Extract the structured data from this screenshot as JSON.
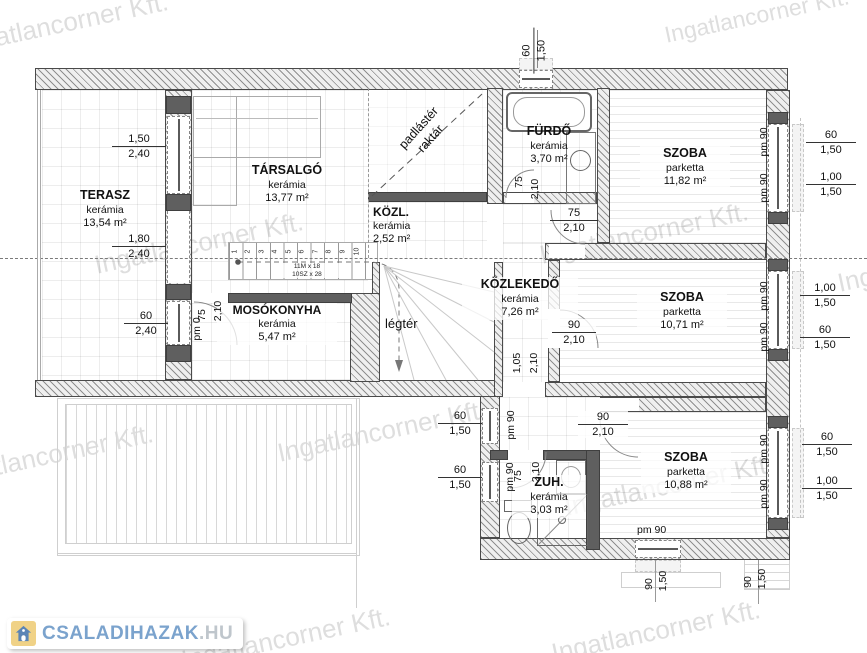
{
  "watermark": {
    "text": "Ingatlancorner Kft.",
    "color": "#dedede"
  },
  "logo": {
    "text_main": "CSALADIHAZAK",
    "text_suffix": ".HU",
    "icon": "house-icon",
    "color_main": "#7ba3cd",
    "color_suffix": "#bfc6cc",
    "icon_bg": "#f0d287",
    "icon_fg": "#5b84b5"
  },
  "rooms": {
    "terasz": {
      "name": "TERASZ",
      "finish": "kerámia",
      "area": "13,54 m²"
    },
    "tarsalgo": {
      "name": "TÁRSALGÓ",
      "finish": "kerámia",
      "area": "13,77 m²"
    },
    "kozl": {
      "name": "KÖZL.",
      "finish": "kerámia",
      "area": "2,52 m²"
    },
    "furdo": {
      "name": "FÜRDŐ",
      "finish": "kerámia",
      "area": "3,70 m²"
    },
    "szoba_felso": {
      "name": "SZOBA",
      "finish": "parketta",
      "area": "11,82 m²"
    },
    "kozlekedo": {
      "name": "KÖZLEKEDŐ",
      "finish": "kerámia",
      "area": "7,26 m²"
    },
    "mosokonyha": {
      "name": "MOSÓKONYHA",
      "finish": "kerámia",
      "area": "5,47 m²"
    },
    "szoba_kozepso": {
      "name": "SZOBA",
      "finish": "parketta",
      "area": "10,71 m²"
    },
    "zuh": {
      "name": "ZUH.",
      "finish": "kerámia",
      "area": "3,03 m²"
    },
    "szoba_also": {
      "name": "SZOBA",
      "finish": "parketta",
      "area": "10,88 m²"
    },
    "legter": {
      "name": "légtér"
    },
    "padlaster": {
      "line1": "padlástér",
      "line2": "raktár"
    }
  },
  "stairs": {
    "line1": "11M x 18",
    "line2": "10SZ x 28",
    "numbers": [
      "1",
      "2",
      "3",
      "4",
      "5",
      "6",
      "7",
      "8",
      "9",
      "10"
    ]
  },
  "dims": {
    "pm90": "pm 90",
    "top_win": {
      "a": "60",
      "b": "1,50"
    },
    "terasz_win": {
      "a": "1,50",
      "b": "2,40"
    },
    "terasz_door": {
      "a": "1,80",
      "b": "2,40"
    },
    "mosok_win": {
      "a": "60",
      "b": "2,40"
    },
    "mosok_pm": {
      "a": "pm 0"
    },
    "mosok_door_w": {
      "a": "75"
    },
    "mosok_door_h": {
      "a": "2,10"
    },
    "furdo_door": {
      "a": "75",
      "b": "2,10"
    },
    "szoba1_door": {
      "a": "75",
      "b": "2,10"
    },
    "szoba1_win1": {
      "a": "60",
      "b": "1,50"
    },
    "szoba1_win2": {
      "a": "1,00",
      "b": "1,50"
    },
    "szoba2_door": {
      "a": "90",
      "b": "2,10"
    },
    "szoba2_win1": {
      "a": "1,00",
      "b": "1,50"
    },
    "szoba2_win2": {
      "a": "60",
      "b": "1,50"
    },
    "kozlekedo_open": {
      "a": "1,05",
      "b": "2,10"
    },
    "szoba3_door": {
      "a": "90",
      "b": "2,10"
    },
    "szoba3_win1": {
      "a": "60",
      "b": "1,50"
    },
    "szoba3_win2": {
      "a": "1,00",
      "b": "1,50"
    },
    "zuh_win1": {
      "a": "60",
      "b": "1,50"
    },
    "zuh_win2": {
      "a": "60",
      "b": "1,50"
    },
    "zuh_door_w": {
      "a": "75"
    },
    "zuh_door_h": {
      "a": "2,10"
    },
    "bottom_win": {
      "a": "90",
      "b": "1,50"
    },
    "bottom_right": {
      "a": "90",
      "b": "1,50"
    }
  }
}
